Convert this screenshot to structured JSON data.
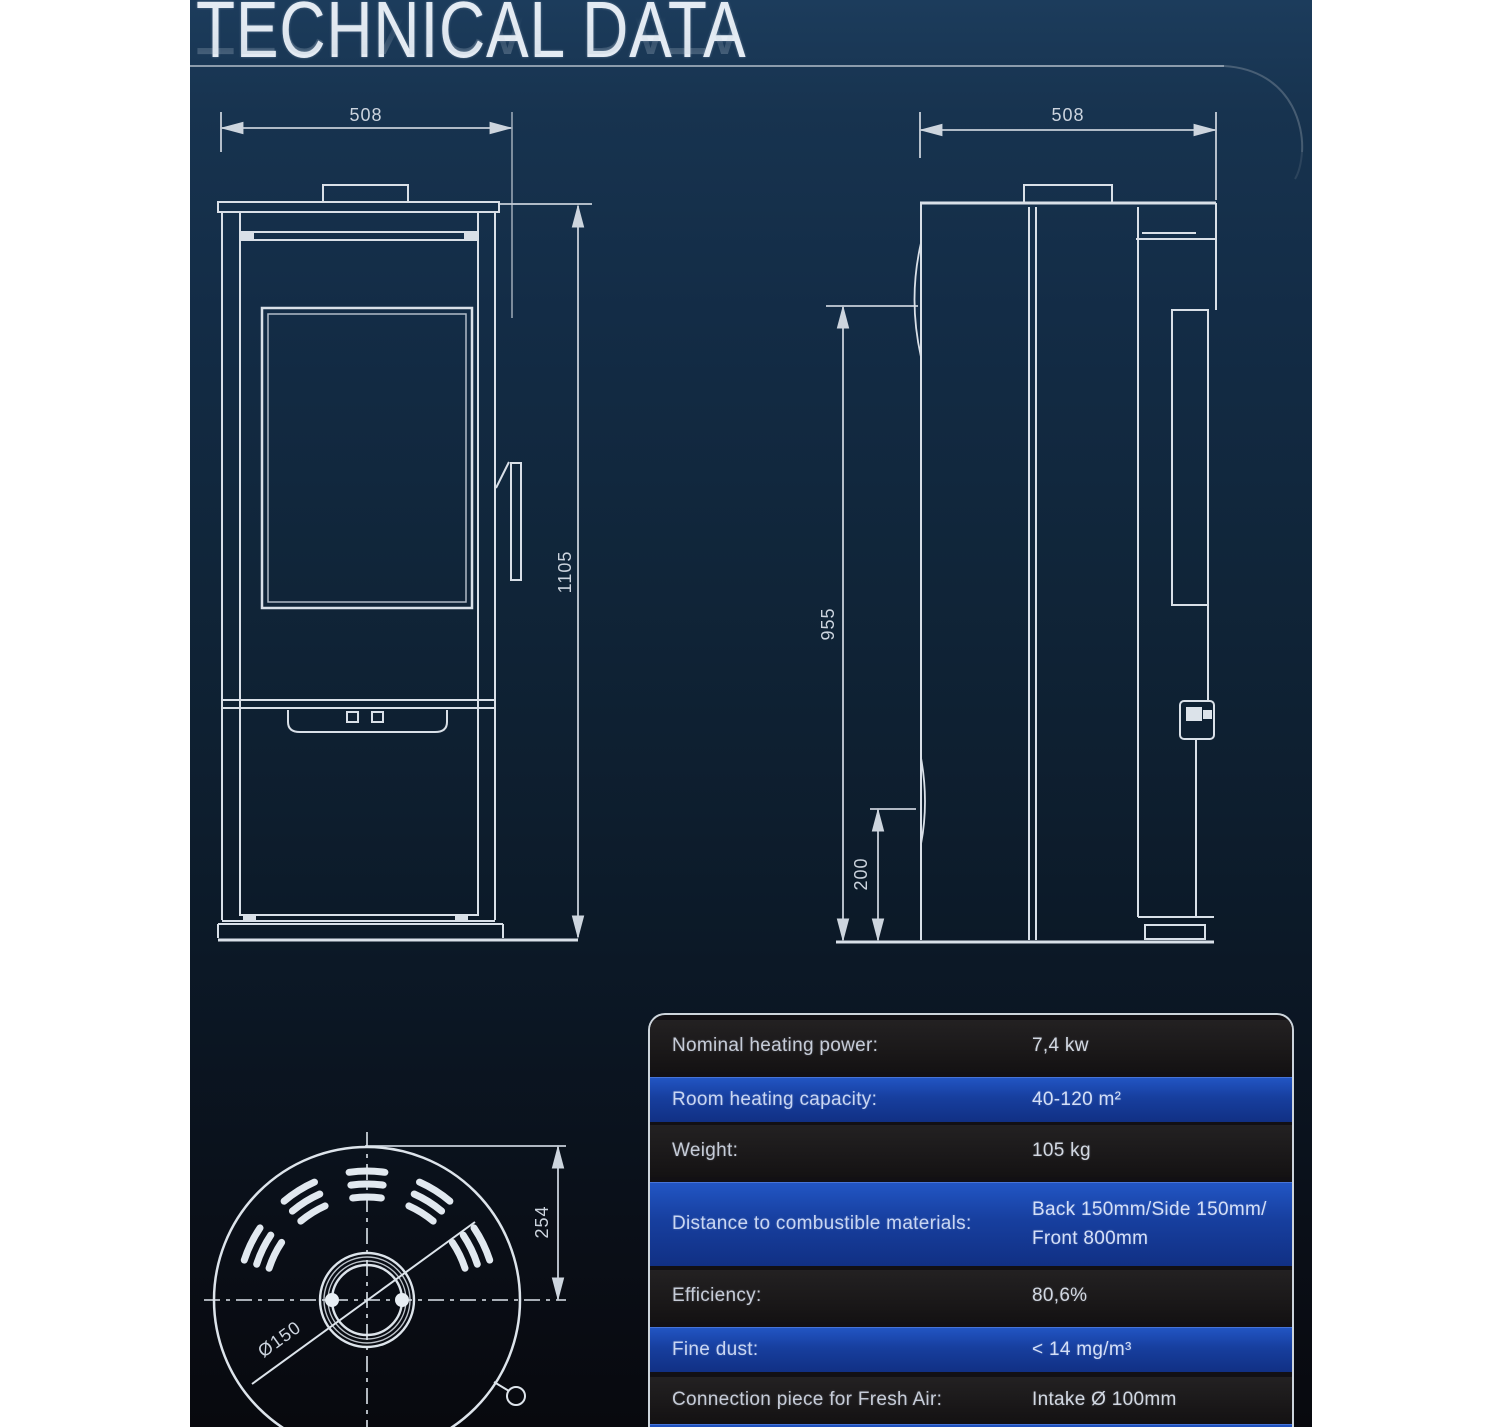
{
  "header": {
    "title": "TECHNICAL DATA"
  },
  "drawings": {
    "front_view": {
      "width_label": "508",
      "height_label": "1105"
    },
    "side_view": {
      "width_label": "508",
      "height_label": "955",
      "clearance_label": "200"
    },
    "top_view": {
      "depth_label": "254",
      "flue_diameter_label": "Ø150"
    }
  },
  "spec_table": {
    "rows": [
      {
        "label": "Nominal heating power:",
        "value": "7,4 kw"
      },
      {
        "label": "Room heating capacity:",
        "value": "40-120 m²"
      },
      {
        "label": "Weight:",
        "value": "105 kg"
      },
      {
        "label": "Distance to combustible materials:",
        "value_line1": "Back 150mm/Side 150mm/",
        "value_line2": "Front 800mm"
      },
      {
        "label": "Efficiency:",
        "value": "80,6%"
      },
      {
        "label": "Fine dust:",
        "value": "< 14 mg/m³"
      },
      {
        "label": "Connection piece for Fresh Air:",
        "value": "Intake Ø 100mm"
      }
    ]
  },
  "colors": {
    "page_bg": "#ffffff",
    "panel_top": "#1c3c5c",
    "panel_bottom": "#08090e",
    "drawing_line": "#d9e0e8",
    "dimension_text": "#ccd4de",
    "table_border": "#cdd5dc",
    "row_dark": "#1b191a",
    "row_blue": "#173f9f",
    "title_text": "#e4ebf3"
  }
}
